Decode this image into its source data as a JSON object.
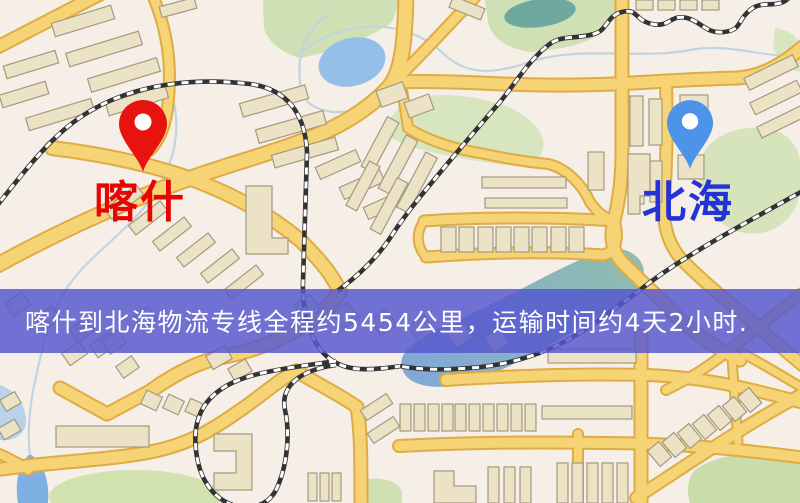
{
  "map": {
    "kind": "street-map",
    "colors": {
      "background": "#f5efe7",
      "road_fill": "#f6d476",
      "road_casing": "#dfab44",
      "park_green": "#d2e2b5",
      "water_blue": "#93bfe8",
      "water_teal": "#8fbcaf",
      "railway": "#333333",
      "building": "#ece2c6"
    }
  },
  "origin": {
    "label": "喀什",
    "pin_color": "#e8130e",
    "pin_icon": "map-pin",
    "label_color": "#e60505"
  },
  "destination": {
    "label": "北海",
    "pin_color": "#4d94e8",
    "pin_icon": "map-pin",
    "label_color": "#2433d6"
  },
  "banner": {
    "text": "喀什到北海物流专线全程约5454公里，运输时间约4天2小时.",
    "background": "rgba(86,88,206,0.84)",
    "text_color": "#ffffff"
  },
  "route_info": {
    "origin": "喀什",
    "destination": "北海",
    "distance_text": "约5454公里",
    "duration_text": "约4天2小时"
  }
}
